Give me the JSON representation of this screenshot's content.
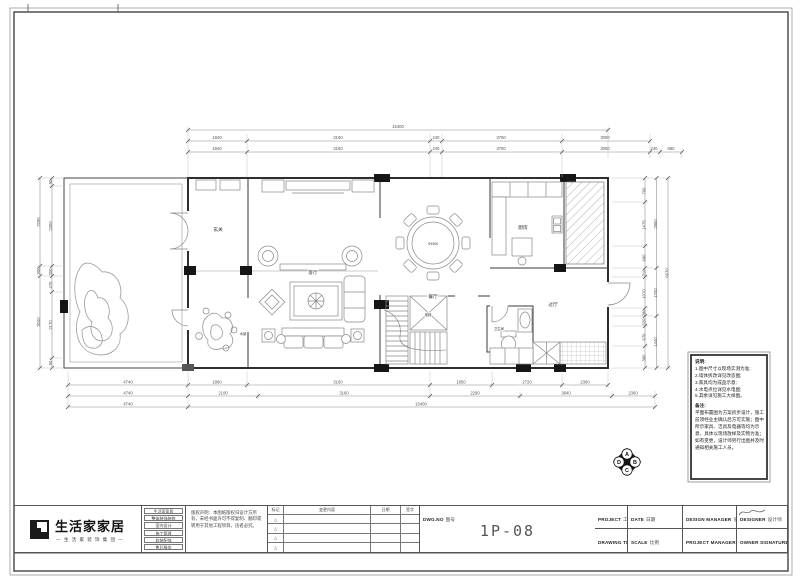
{
  "logo": {
    "name": "生活家家居",
    "tagline": "— 生 活 家 装 饰 集 团 —"
  },
  "company_rows": [
    "生活家家居",
    "整体装饰装修",
    "室内设计",
    "施工管理",
    "软装配饰",
    "售后服务"
  ],
  "legal_note": "版权声明：本图纸版权归设计方所有，未经书面许可不得复制、翻印或转用于其他工程项目，违者必究。",
  "revision": {
    "headers": [
      "标记",
      "变更内容",
      "日期",
      "签字"
    ],
    "rows": [
      "△",
      "△",
      "△",
      "△"
    ]
  },
  "titleblock": {
    "project_en": "PROJECT",
    "project_cn": "工程名称",
    "drawing_en": "DRAWING TITLE",
    "drawing_cn": "图纸名称",
    "drawing_value": "平面布置图",
    "date_en": "DATE",
    "date_cn": "日期",
    "scale_en": "SCALE",
    "scale_cn": "比例",
    "dm_en": "DESIGN MANAGER",
    "dm_cn": "设计总监",
    "pm_en": "PROJECT MANAGER",
    "pm_cn": "项目经理",
    "designer_en": "DESIGNER",
    "designer_cn": "设计师",
    "owner_en": "OWNER SIGNATURE",
    "owner_cn": "业主签字",
    "dwg_en": "DWG.NO",
    "dwg_cn": "图号",
    "dwg_no": "1P-08"
  },
  "notes": {
    "title": "说明:",
    "items": [
      "1.图中尺寸以现场实测为准;",
      "2.墙体拆改详见改造图;",
      "3.家具均为成品示意;",
      "4.水电点位详见水电图;",
      "5.其余详见施工大样图。"
    ],
    "remark_title": "备注:",
    "remark": "平面布置图为方案初步设计，施工前须经业主确认后方可实施；图中所示家具、洁具及电器等均为示意，具体以现场放样及实物为准；如有变更，设计师另行出图并及时通知相关施工人员。"
  },
  "rooms": {
    "entry": "玄关",
    "living": "客厅",
    "dining": "餐厅",
    "dining_table": "Φ1500",
    "kitchen": "厨房",
    "hallway": "过厅",
    "bathroom": "卫生间",
    "elevator": "电梯",
    "landscape": "水景"
  },
  "dims": {
    "top_overall": "15400",
    "top_row1": [
      "1840",
      "3160",
      "240",
      "3700",
      "3000"
    ],
    "top_row2": [
      "1840",
      "3160",
      "240",
      "3700",
      "3000",
      "240",
      "660"
    ],
    "bot_row1": [
      "4740",
      "1860",
      "3160",
      "1850",
      "2720",
      "2360"
    ],
    "bot_row2": [
      "4740",
      "2100",
      "3160",
      "2290",
      "3840",
      "2360"
    ],
    "bot_row3": [
      "4740",
      "15400"
    ],
    "left_outer": [
      "2290",
      "300",
      "3040"
    ],
    "left_inner": [
      "90",
      "2300",
      "300",
      "470",
      "2170",
      "90"
    ],
    "right_outer": [
      "700",
      "1475",
      "690",
      "310",
      "1070",
      "280",
      "320",
      "670",
      "380"
    ],
    "right_inner": [
      "2960",
      "1700",
      "1440"
    ],
    "right_overall": "6670"
  },
  "marker": {
    "a": "A",
    "b": "B",
    "c": "C",
    "d": "D"
  }
}
